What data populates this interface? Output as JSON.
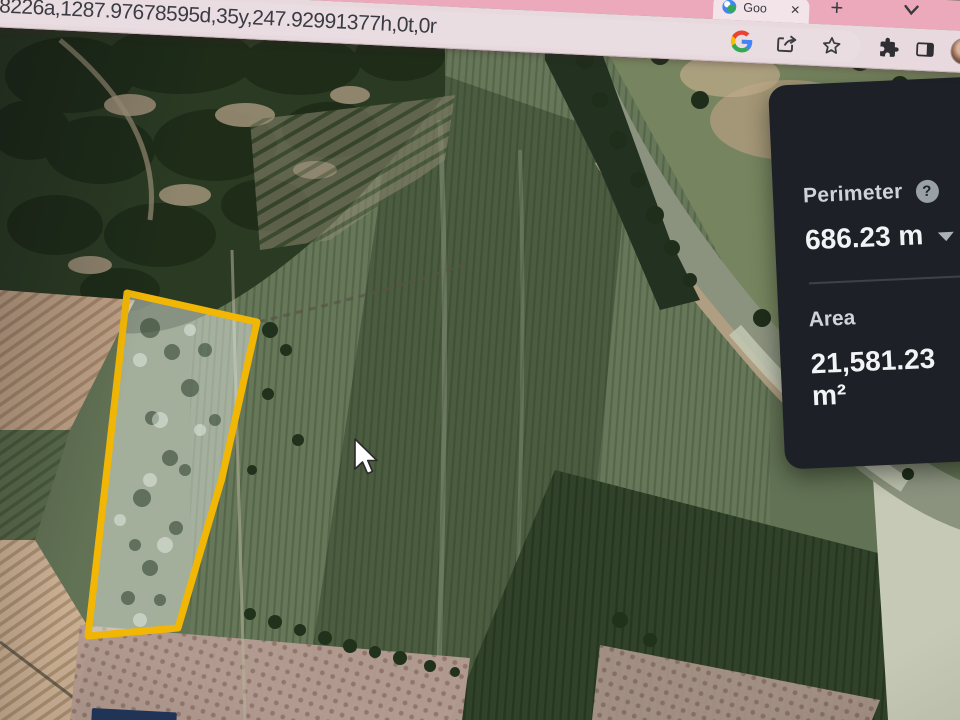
{
  "window": {
    "tab": {
      "favicon": "earth-globe-icon",
      "title": "Goo",
      "close_glyph": "✕"
    },
    "new_tab_glyph": "+",
    "overflow_chevron": "chevron-down",
    "address_url": "8868226a,1287.97678595d,35y,247.92991377h,0t,0r",
    "toolbar_icons": [
      "google-g",
      "share",
      "bookmark-star",
      "extensions-puzzle",
      "side-panel",
      "profile-avatar"
    ]
  },
  "measure_panel": {
    "perimeter": {
      "label": "Perimeter",
      "help_glyph": "?",
      "value": "686.23 m"
    },
    "area": {
      "label": "Area",
      "value": "21,581.23 m²"
    },
    "colors": {
      "background": "#1d2127",
      "label": "#cfd3d9",
      "value": "#f2f3f5",
      "divider": "#3d424a"
    }
  },
  "map": {
    "type": "satellite-imagery",
    "measure_polygon": {
      "stroke": "#f2b705",
      "fill": "rgba(228,234,226,0.5)",
      "points": [
        [
          127,
          293
        ],
        [
          257,
          322
        ],
        [
          222,
          478
        ],
        [
          178,
          628
        ],
        [
          88,
          636
        ]
      ]
    },
    "cursor": {
      "x": 354,
      "y": 438
    }
  }
}
